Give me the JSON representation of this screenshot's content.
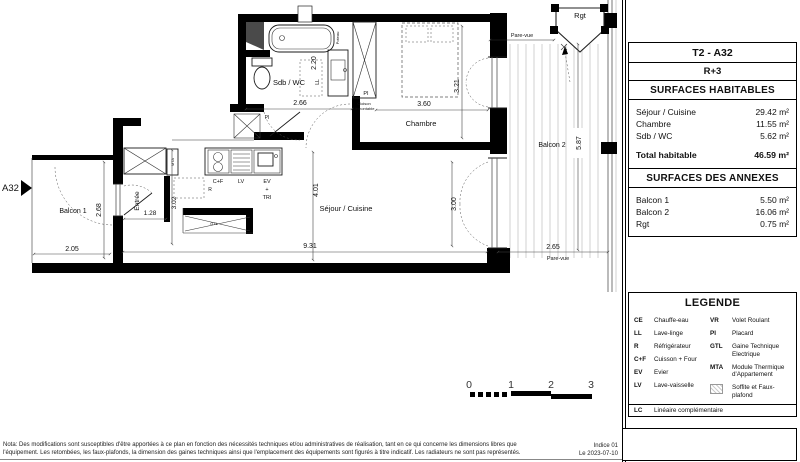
{
  "title_block": {
    "unit": "T2 - A32",
    "floor": "R+3",
    "habitable_header": "SURFACES HABITABLES",
    "habitable_rows": [
      {
        "label": "Séjour / Cuisine",
        "value": "29.42 m²"
      },
      {
        "label": "Chambre",
        "value": "11.55 m²"
      },
      {
        "label": "Sdb / WC",
        "value": "5.62 m²"
      }
    ],
    "total_label": "Total habitable",
    "total_value": "46.59 m²",
    "annexes_header": "SURFACES DES ANNEXES",
    "annexes_rows": [
      {
        "label": "Balcon 1",
        "value": "5.50 m²"
      },
      {
        "label": "Balcon 2",
        "value": "16.06 m²"
      },
      {
        "label": "Rgt",
        "value": "0.75 m²"
      }
    ]
  },
  "legend": {
    "title": "LEGENDE",
    "left": [
      {
        "abbr": "CE",
        "label": "Chauffe-eau"
      },
      {
        "abbr": "LL",
        "label": "Lave-linge"
      },
      {
        "abbr": "R",
        "label": "Réfrigérateur"
      },
      {
        "abbr": "C+F",
        "label": "Cuisson + Four"
      },
      {
        "abbr": "EV",
        "label": "Evier"
      },
      {
        "abbr": "LV",
        "label": "Lave-vaisselle"
      }
    ],
    "right": [
      {
        "abbr": "VR",
        "label": "Volet Roulant"
      },
      {
        "abbr": "PI",
        "label": "Placard"
      },
      {
        "abbr": "GTL",
        "label": "Gaine Technique Electrique"
      },
      {
        "abbr": "MTA",
        "label": "Module Thermique d'Appartement"
      },
      {
        "abbr": "",
        "label": "Soffite et Faux-plafond"
      }
    ],
    "lc": {
      "abbr": "LC",
      "label": "Linéaire complémentaire"
    }
  },
  "plan": {
    "labels": {
      "apartment": "A32",
      "balcon1": "Balcon 1",
      "balcon2": "Balcon 2",
      "entree": "Entrée",
      "sdb": "Sdb / WC",
      "chambre": "Chambre",
      "sejour": "Séjour / Cuisine",
      "rgt": "Rgt",
      "pare_vue": "Pare-vue",
      "pi": "PI",
      "cloison_line1": "Cloison",
      "cloison_line2": "démontable",
      "ll": "LL",
      "poteau": "Poteau",
      "cf": "C+F",
      "r": "R",
      "lv": "LV",
      "ev": "EV",
      "plus": "+",
      "tri": "TRI",
      "mta": "MTA",
      "gtl": "GTL"
    },
    "dims": {
      "balcon1_w": "2.05",
      "balcon1_h": "2.68",
      "entree_w": "1.28",
      "entree_h": "3.02",
      "sdb_w": "2.66",
      "sdb_h": "2.20",
      "chambre_w": "3.60",
      "chambre_h": "3.21",
      "sejour_h": "4.01",
      "sejour_w": "9.31",
      "sejour_door": "3.00",
      "balcon2_h": "5.87",
      "balcon2_w": "2.65"
    }
  },
  "scale": {
    "ticks": [
      "0",
      "1",
      "2",
      "3"
    ]
  },
  "notes": {
    "line1": "Nota: Des modifications sont susceptibles d'être apportées à ce plan en fonction des nécessités techniques et/ou administratives de réalisation, tant en ce qui concerne les dimensions libres que",
    "line2": "l'équipement. Les retombées, les faux-plafonds, la dimension des gaines techniques ainsi que l'emplacement des équipements sont figurés à titre indicatif. Les radiateurs ne sont pas représentés.",
    "indice": "Indice 01",
    "date": "Le 2023-07-10"
  }
}
